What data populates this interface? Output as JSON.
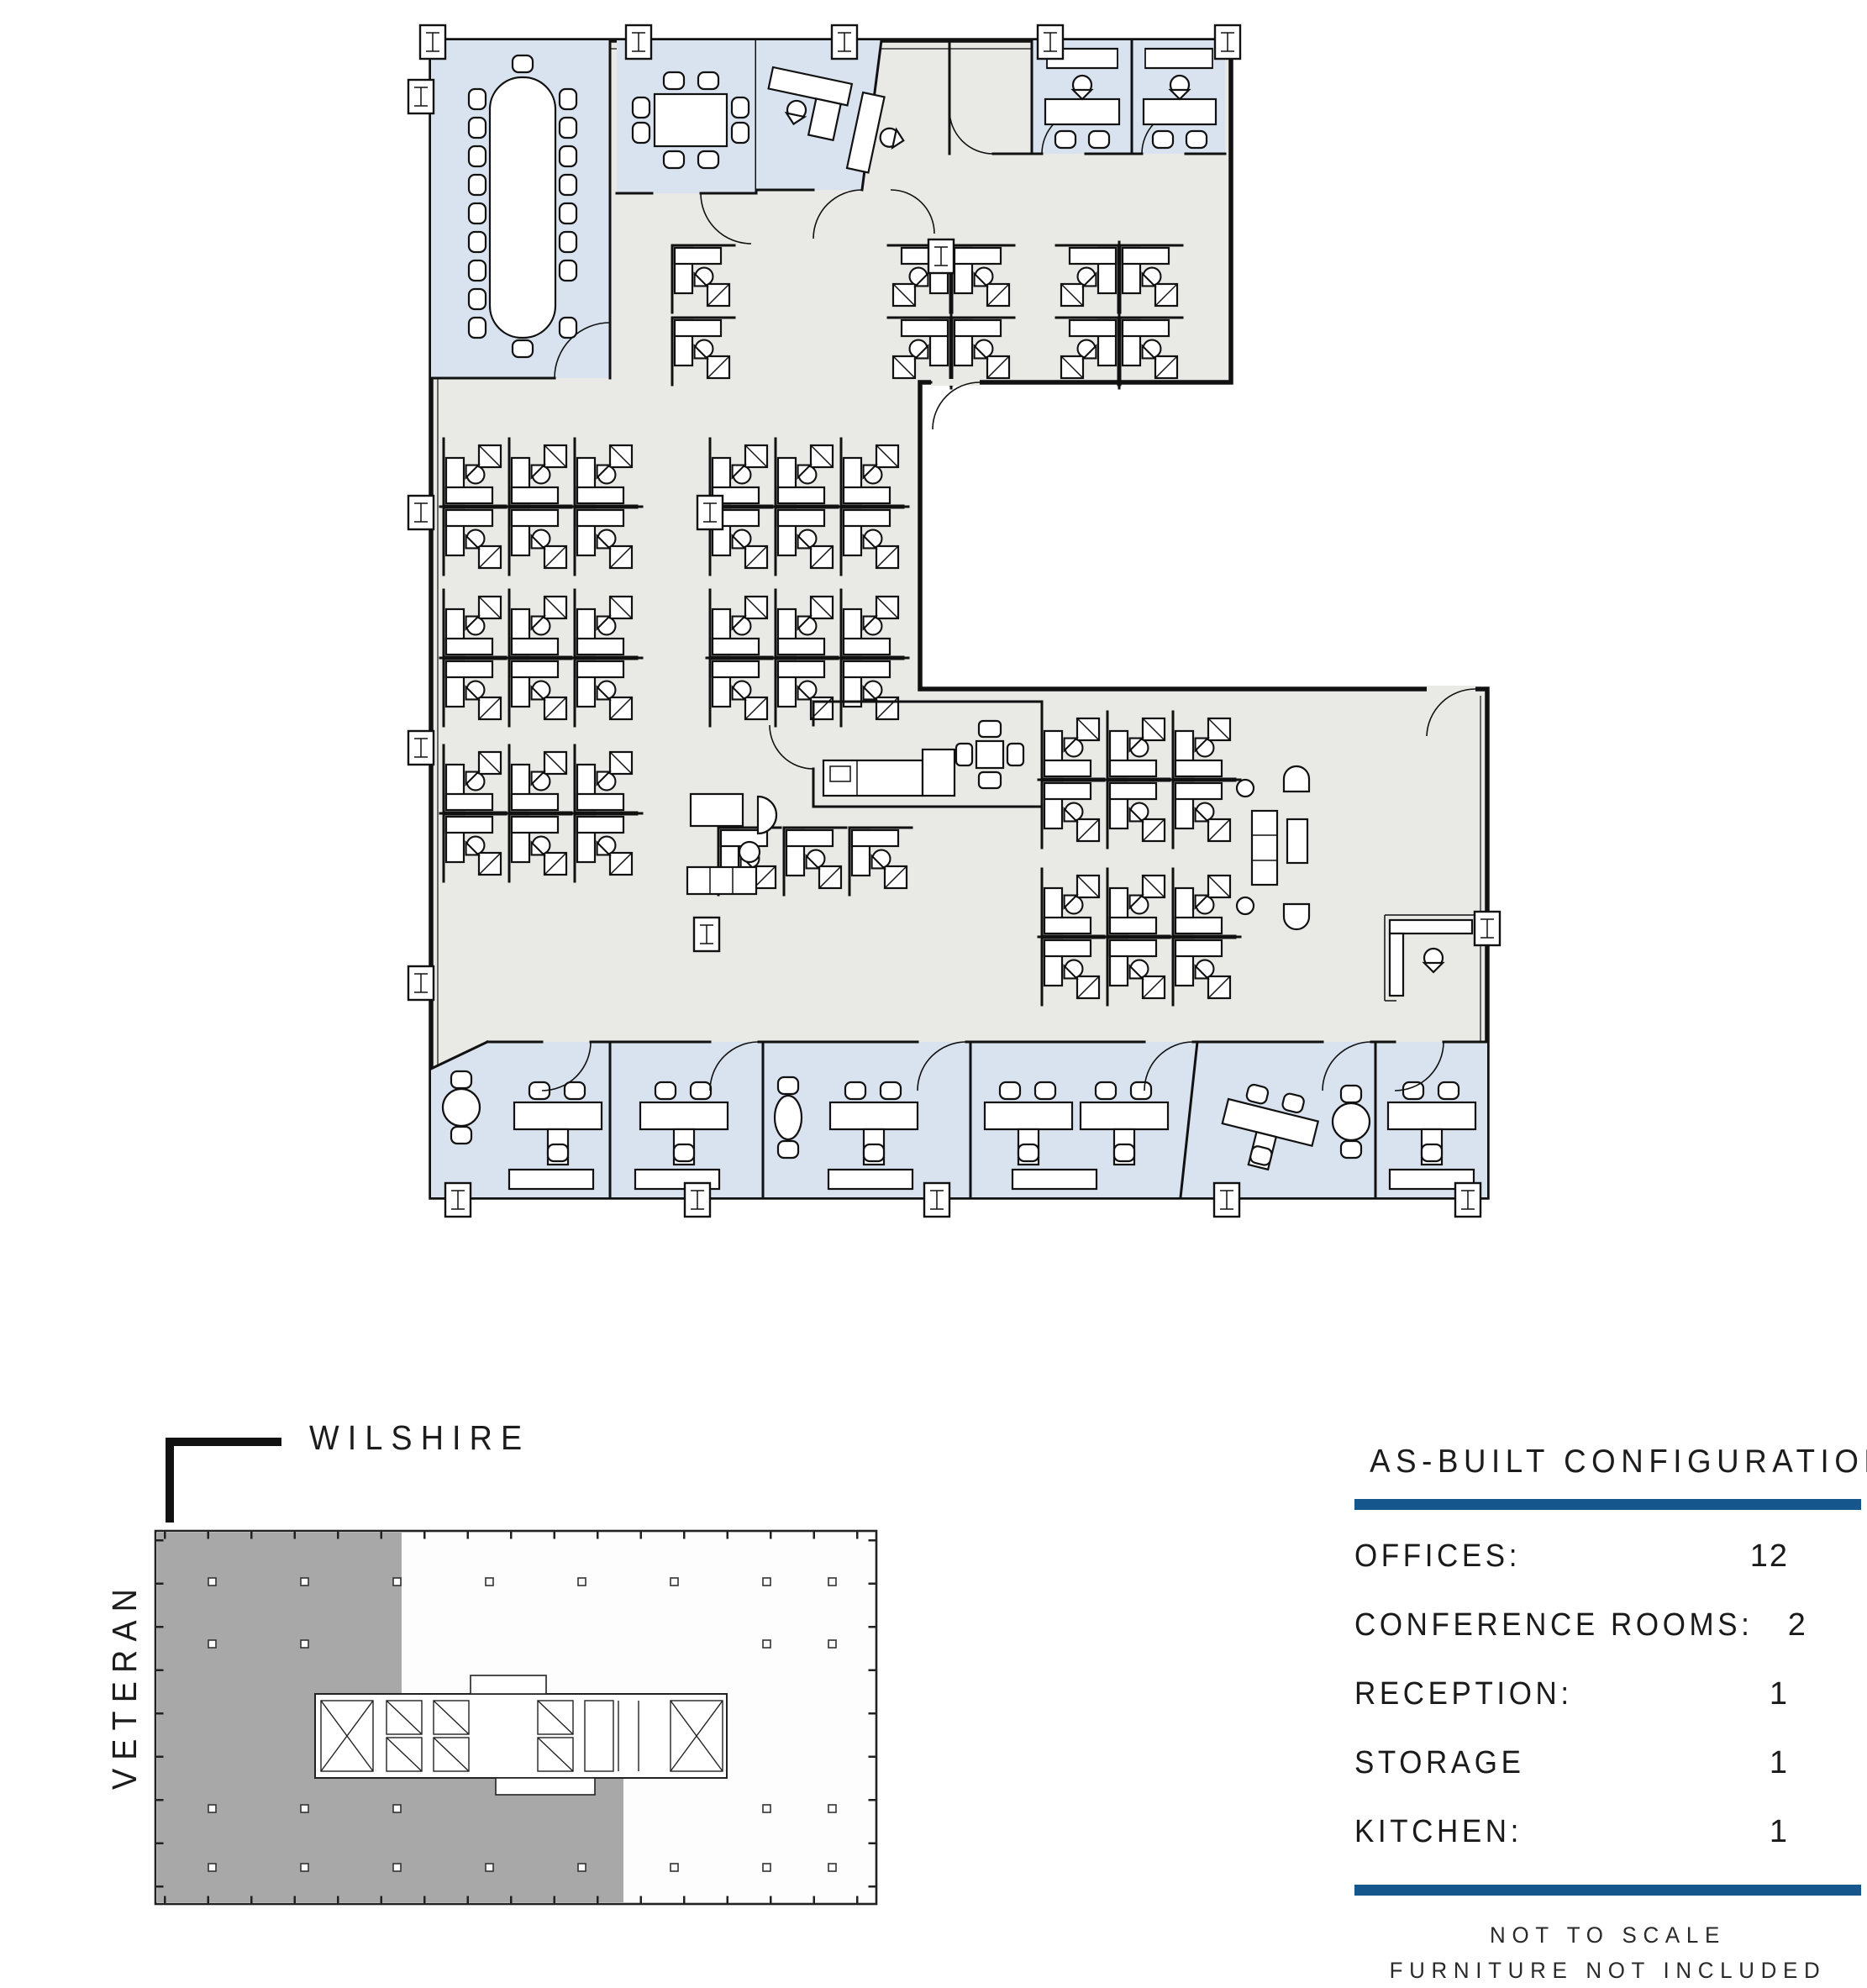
{
  "page": {
    "title": "As-Built Configuration Floor Plan"
  },
  "floor_plan": {
    "type": "office-suite-plan",
    "colors": {
      "room_fill_blue": "#d9e2ef",
      "open_area_gray": "#e9e9e6",
      "wall_black": "#111111",
      "keyplan_shade_gray": "#a8a8a8",
      "accent_blue": "#15578d"
    },
    "features": [
      "large boardroom with oval table and 20 chairs",
      "conference room with square table and 8 chairs",
      "private offices along top and bottom walls",
      "open plan cubicle clusters",
      "kitchen with 4-seat table and counter",
      "copy/storage area",
      "lounge with sofa and armchairs",
      "L-shaped reception desk"
    ]
  },
  "key_plan": {
    "street_top": "WILSHIRE",
    "street_left": "VETERAN",
    "shaded_area": "leased suite (left and lower-left portion of floor)"
  },
  "config_panel": {
    "title": "AS-BUILT CONFIGURATION",
    "rows": [
      {
        "label": "OFFICES:",
        "value": "12"
      },
      {
        "label": "CONFERENCE ROOMS:",
        "value": "2"
      },
      {
        "label": "RECEPTION:",
        "value": "1"
      },
      {
        "label": "STORAGE",
        "value": "1"
      },
      {
        "label": "KITCHEN:",
        "value": "1"
      }
    ],
    "notes": [
      "NOT TO SCALE",
      "FURNITURE NOT INCLUDED"
    ]
  }
}
